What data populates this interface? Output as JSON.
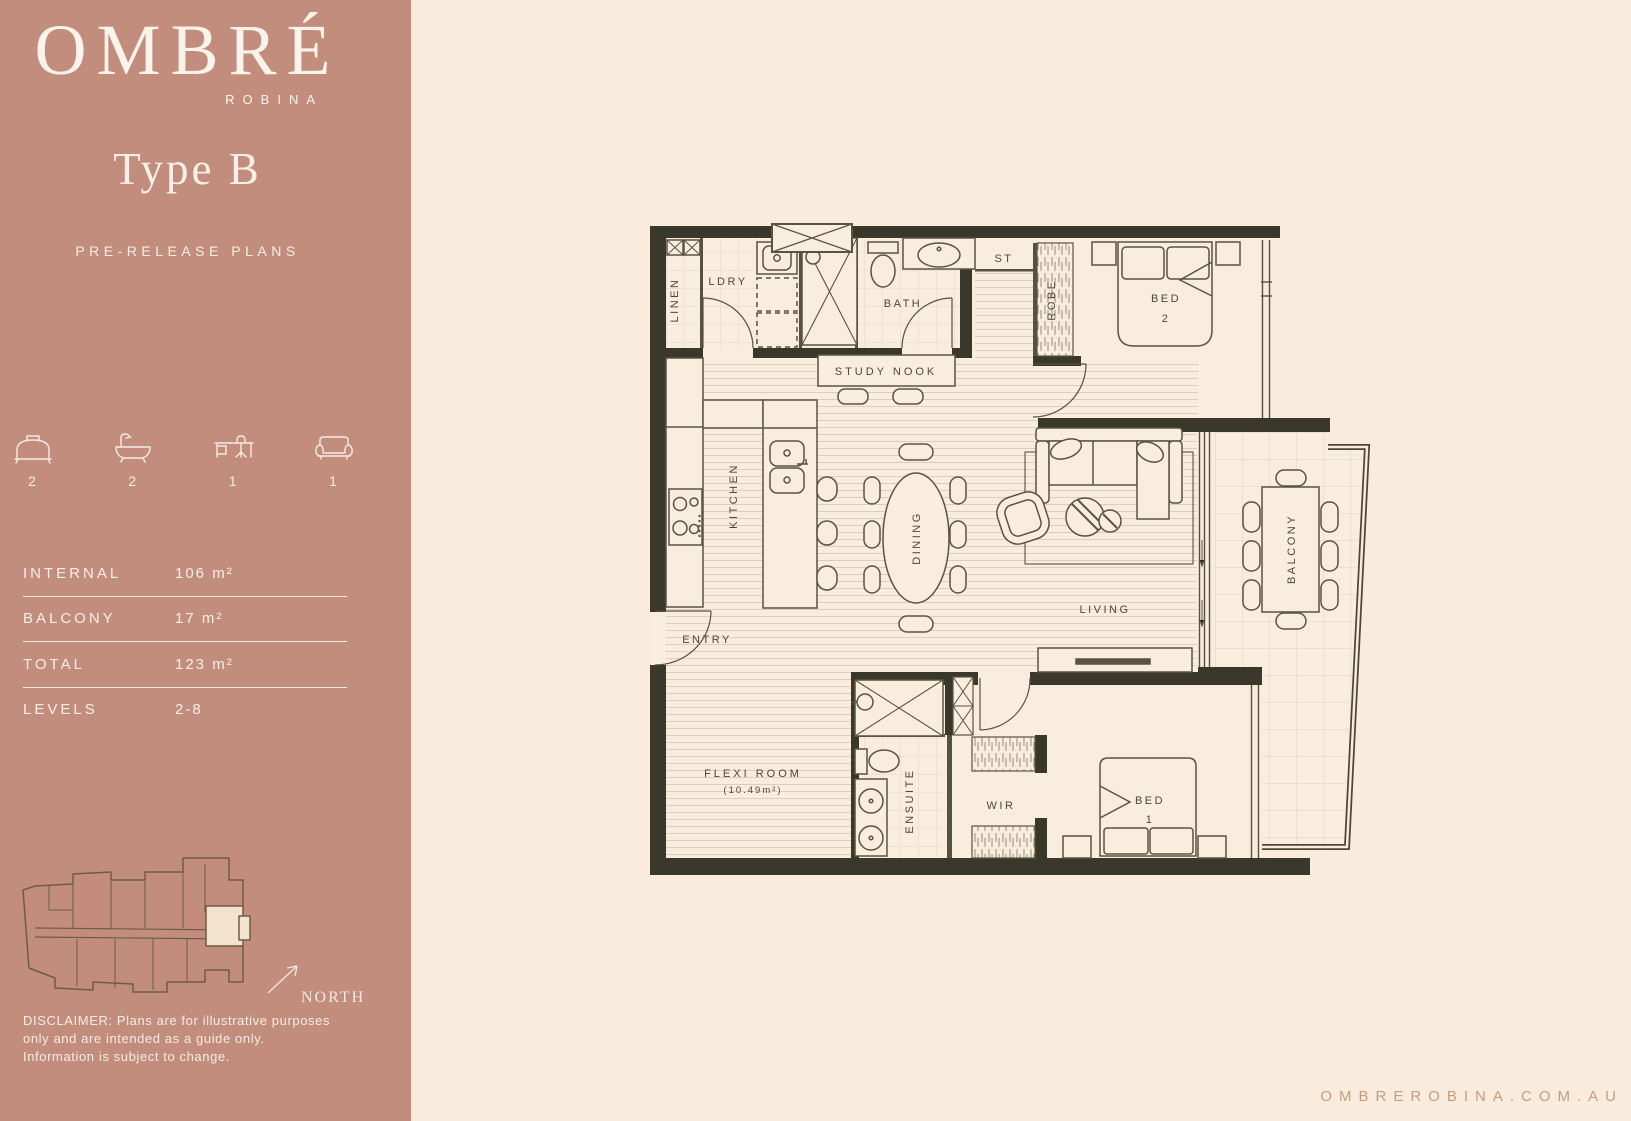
{
  "sidebar": {
    "brand": {
      "name": "OMBRÉ",
      "sub": "ROBINA"
    },
    "plan_type": "Type B",
    "status": "PRE-RELEASE PLANS",
    "features": [
      {
        "icon": "bed-icon",
        "count": "2"
      },
      {
        "icon": "bath-icon",
        "count": "2"
      },
      {
        "icon": "desk-icon",
        "count": "1"
      },
      {
        "icon": "sofa-icon",
        "count": "1"
      }
    ],
    "stats": [
      {
        "label": "INTERNAL",
        "value": "106 m²"
      },
      {
        "label": "BALCONY",
        "value": "17 m²"
      },
      {
        "label": "TOTAL",
        "value": "123 m²"
      },
      {
        "label": "LEVELS",
        "value": "2-8"
      }
    ],
    "north_label": "NORTH",
    "disclaimer": {
      "line1": "DISCLAIMER: Plans are for illustrative purposes",
      "line2": "only and are intended as a guide only.",
      "line3": "Information is subject to change."
    }
  },
  "plan": {
    "rooms": {
      "linen": "LINEN",
      "laundry": "LDRY",
      "bath": "BATH",
      "storage": "ST",
      "robe": "ROBE",
      "bed2_line1": "BED",
      "bed2_line2": "2",
      "study_nook": "STUDY NOOK",
      "kitchen": "KITCHEN",
      "dining": "DINING",
      "living": "LIVING",
      "balcony": "BALCONY",
      "entry": "ENTRY",
      "flexi_line1": "FLEXI ROOM",
      "flexi_line2": "(10.49m²)",
      "ensuite": "ENSUITE",
      "wir": "WIR",
      "bed1_line1": "BED",
      "bed1_line2": "1"
    }
  },
  "footer": {
    "url": "OMBREROBINA.COM.AU"
  },
  "colors": {
    "sidebar": "#c28d7c",
    "background": "#f9ecdd",
    "wall": "#3a382a",
    "line": "#57513f",
    "label": "#4d4736",
    "highlight": "#f3e3cd",
    "url_text": "#c59d7c"
  }
}
